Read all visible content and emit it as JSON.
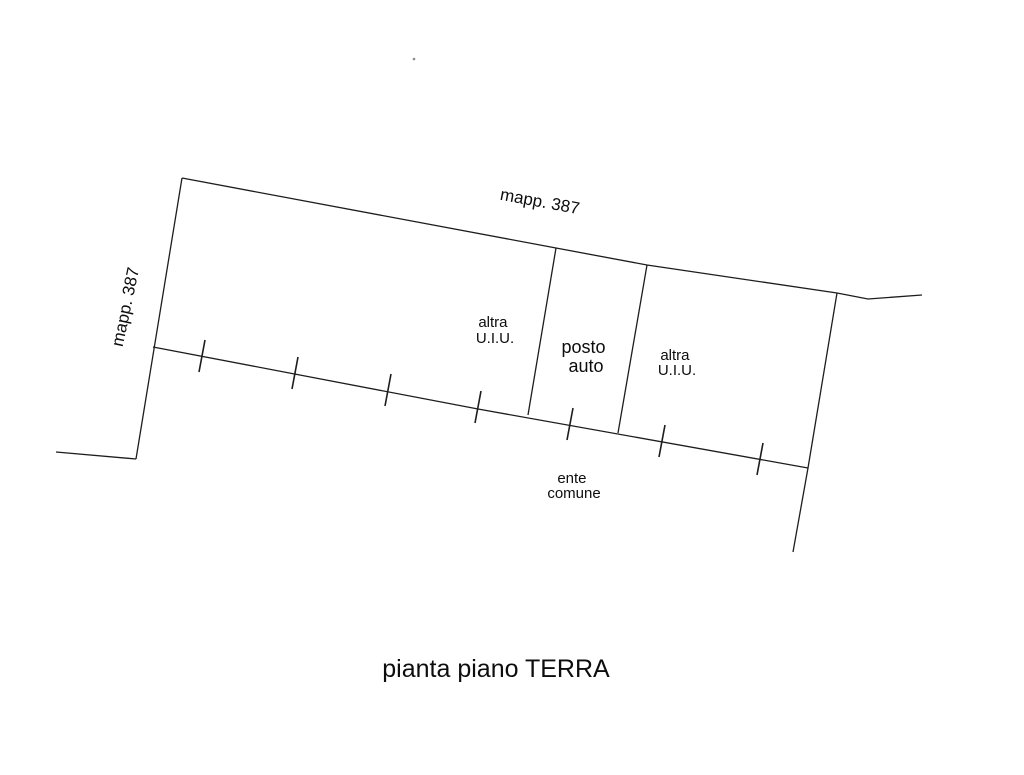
{
  "drawing": {
    "title": "pianta piano TERRA",
    "labels": {
      "parcel_top": "mapp. 387",
      "parcel_left": "mapp. 387",
      "unit_left_line1": "altra",
      "unit_left_line2": "U.I.U.",
      "parking_line1": "posto",
      "parking_line2": "auto",
      "unit_right_line1": "altra",
      "unit_right_line2": "U.I.U.",
      "common_area_line1": "ente",
      "common_area_line2": "comune"
    },
    "colors": {
      "line": "#1d1d1d",
      "text": "#0d0d0d",
      "background": "#ffffff"
    }
  }
}
